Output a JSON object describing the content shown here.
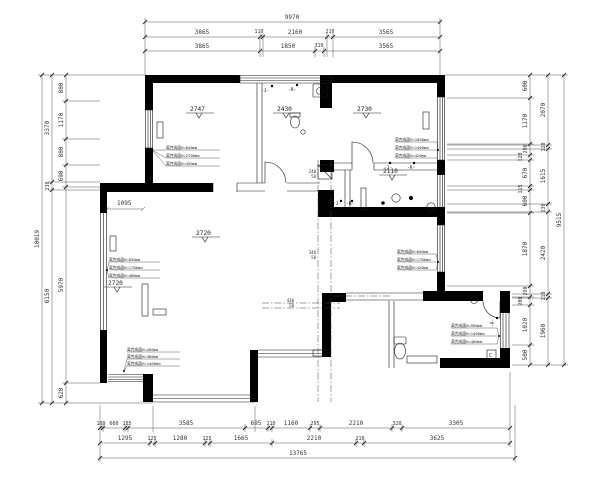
{
  "drawing_type": "residential-floor-plan-cad",
  "colors": {
    "background": "#ffffff",
    "walls": "#000000",
    "lines": "#1a1a1a",
    "dims": "#333333"
  },
  "dimensions": {
    "top": {
      "overall": "9970",
      "chain1": [
        "3865",
        "110",
        "2160",
        "210",
        "3565"
      ],
      "chain2": [
        "3865",
        "1850",
        "310",
        "3565"
      ]
    },
    "bottom": {
      "chain1": [
        "100",
        "660",
        "105",
        "3585",
        "695",
        "110",
        "1160",
        "295",
        "2210",
        "320",
        "3305"
      ],
      "chain2": [
        "1295",
        "125",
        "1280",
        "125",
        "1665",
        "2210",
        "210",
        "3625"
      ],
      "overall": "13765"
    },
    "left": {
      "chain_inner": [
        "800",
        "1170",
        "800",
        "690",
        "5970",
        "620"
      ],
      "chain_outer": [
        "3370",
        "230",
        "6150"
      ],
      "overall": "10019"
    },
    "right": {
      "chain_inner": [
        "600",
        "1170",
        "290",
        "120",
        "670",
        "115",
        "600",
        "1870",
        "290",
        "200",
        "1020",
        "500"
      ],
      "chain_outer": [
        "2070",
        "120",
        "1615",
        "230",
        "2420",
        "110",
        "1960"
      ],
      "overall": "9515"
    }
  },
  "levels": {
    "room_top_left": "2747",
    "room_top_mid": "2430",
    "room_top_right": "2730",
    "room_mid_right": "2110",
    "living_upper": "2720",
    "living_lower": "2720"
  },
  "inline_dims": {
    "opening": "1095",
    "duct1": [
      "240",
      "50"
    ],
    "duct2": [
      "340",
      "50"
    ],
    "duct3": [
      "430",
      "50"
    ]
  },
  "plumbing": {
    "cold": "-J-",
    "hot": "-R-",
    "box": "C"
  },
  "annotations": {
    "top_left_room": [
      "离完成面H=840mm",
      "离完成面H=2700mm",
      "离完成面H=450mm"
    ],
    "top_right_room": [
      "离完成面H=1050mm",
      "离完成面H=1400mm",
      "离完成面H=420mm"
    ],
    "mid_right_room": [
      "离完成面H=840mm",
      "离完成面H=1700mm",
      "离完成面H=420mm"
    ],
    "living_left": [
      "离完成面H=830mm",
      "离完成面H=1700mm",
      "离完成面H=400mm"
    ],
    "bottom_left": [
      "离完成面H=260mm",
      "离完成面H=380mm",
      "离完成面H=1460mm"
    ],
    "bathroom": [
      "离完成面H=950mm",
      "离完成面H=1400mm",
      "离完成面H=400mm"
    ]
  }
}
